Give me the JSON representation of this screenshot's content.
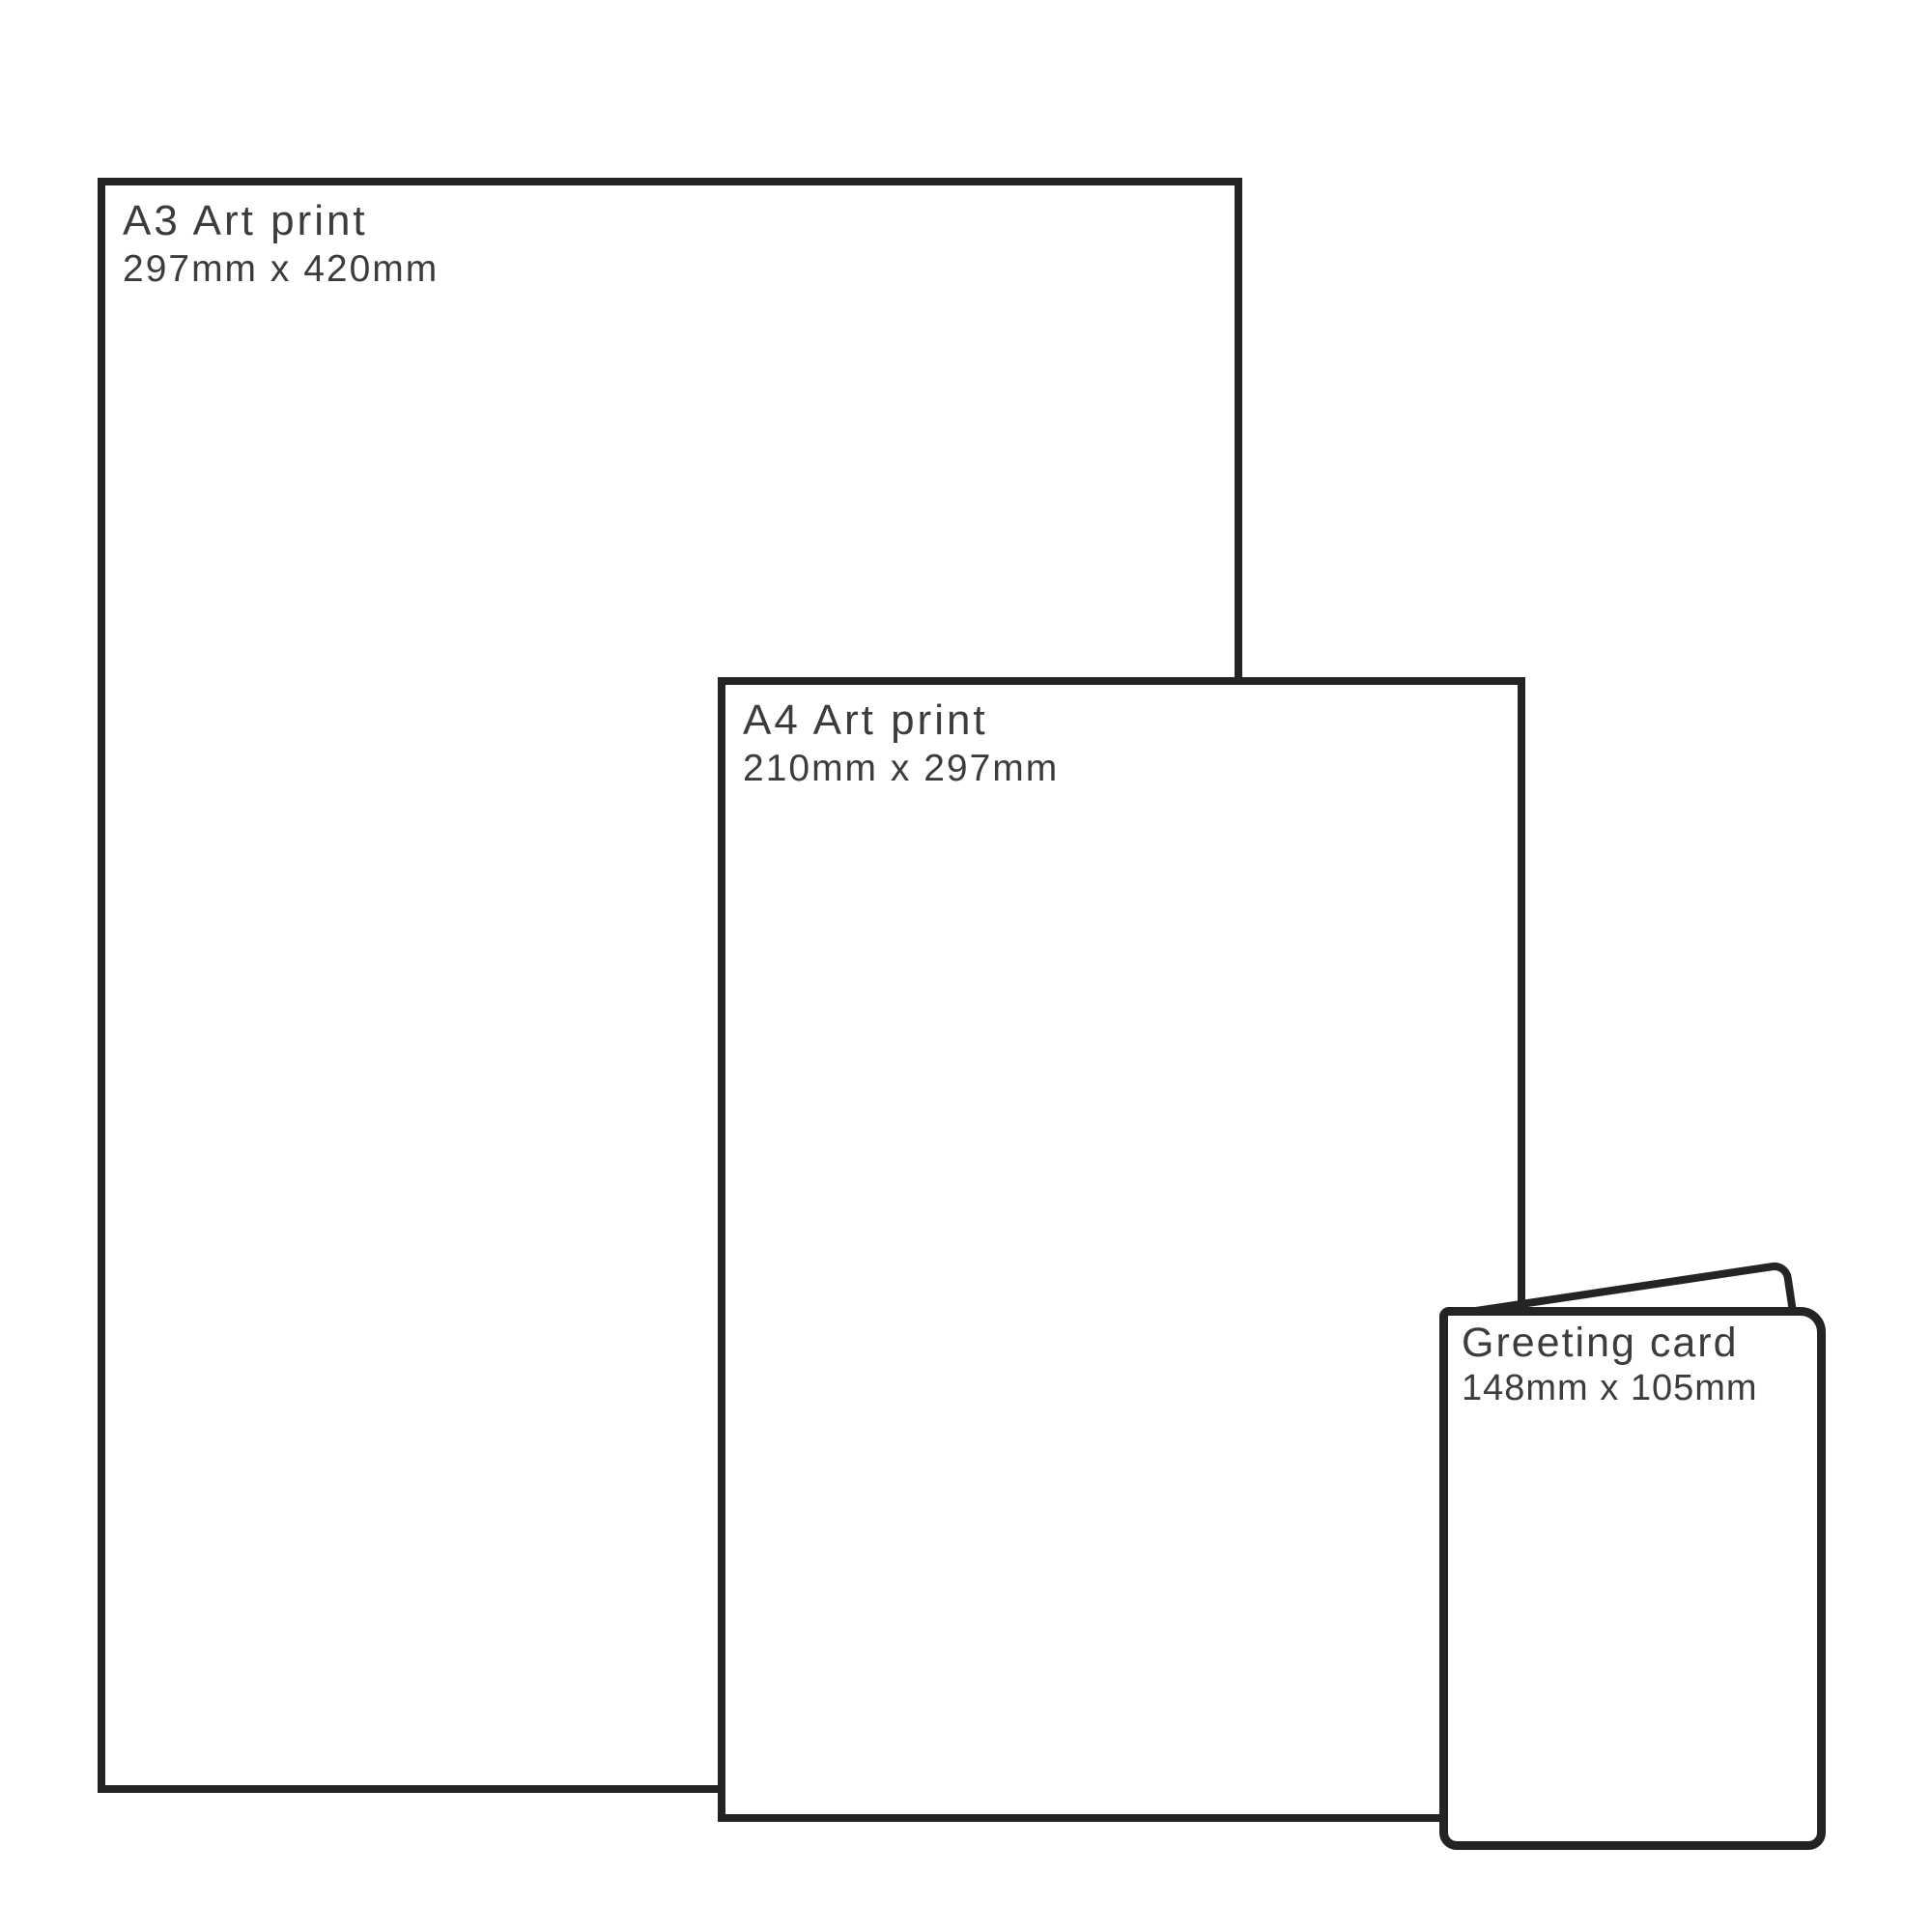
{
  "page": {
    "background_color": "#ffffff",
    "outline_color": "#242424",
    "text_color": "#3c3c3c"
  },
  "sheets": [
    {
      "title": "A3 Art print",
      "size": "297mm x 420mm"
    },
    {
      "title": "A4 Art print",
      "size": "210mm x 297mm"
    },
    {
      "title": "Greeting card",
      "size": "148mm x 105mm"
    }
  ]
}
